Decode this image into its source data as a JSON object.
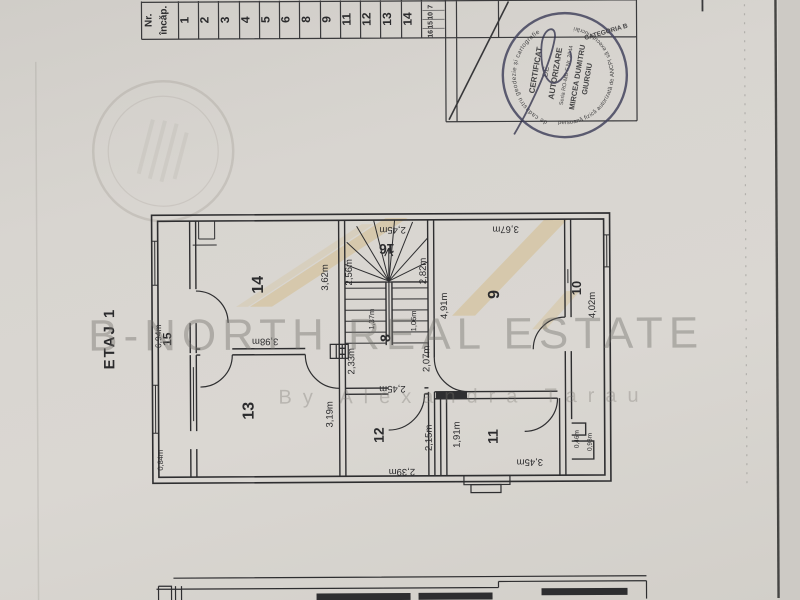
{
  "page": {
    "floor_label": "ETAJ 1",
    "watermark_line1": "B-NORTH REAL ESTATE",
    "watermark_line2": "By Alexandra Tarau"
  },
  "room_table": {
    "header_line1": "Nr.",
    "header_line2": "încăp.",
    "cells": [
      "1",
      "2",
      "3",
      "4",
      "5",
      "6",
      "8",
      "9",
      "11",
      "12",
      "13",
      "14"
    ],
    "stacked": [
      "7",
      "10",
      "15",
      "16"
    ]
  },
  "stamp": {
    "line1": "CERTIFICAT",
    "line2": "DE",
    "line3": "AUTORIZARE",
    "line4": "Seria RO-MB-F Nr. 2044",
    "line5": "MIRCEA DUMITRU",
    "line6": "GIURGIU",
    "rim_top": "de cadastru geodezie și cartografie",
    "rim_bottom": "persoană fizică autorizată de ANCPI să execute lucrări",
    "rim_side": "CATEGORIA B"
  },
  "plan": {
    "rooms": [
      {
        "n": "14"
      },
      {
        "n": "15"
      },
      {
        "n": "16"
      },
      {
        "n": "8"
      },
      {
        "n": "9"
      },
      {
        "n": "10"
      },
      {
        "n": "13"
      },
      {
        "n": "12"
      },
      {
        "n": "11"
      }
    ],
    "dims": [
      {
        "v": "3,62m"
      },
      {
        "v": "2,45m"
      },
      {
        "v": "2,56m"
      },
      {
        "v": "2,82m"
      },
      {
        "v": "1,37m"
      },
      {
        "v": "1,06m"
      },
      {
        "v": "4,91m"
      },
      {
        "v": "3,67m"
      },
      {
        "v": "4,02m"
      },
      {
        "v": "2,33m"
      },
      {
        "v": "2,07m"
      },
      {
        "v": "3,98m"
      },
      {
        "v": "6,94m"
      },
      {
        "v": "3,19m"
      },
      {
        "v": "2,45m"
      },
      {
        "v": "2,15m"
      },
      {
        "v": "2,39m"
      },
      {
        "v": "1,91m"
      },
      {
        "v": "3,45m"
      },
      {
        "v": "0,84m"
      },
      {
        "v": "0,46m"
      },
      {
        "v": "0,93m"
      }
    ]
  },
  "colors": {
    "paper": "#d8d5d0",
    "ink": "#2e2e30",
    "stamp_ink": "#45455f",
    "logo_tan": "#d2b97e"
  }
}
